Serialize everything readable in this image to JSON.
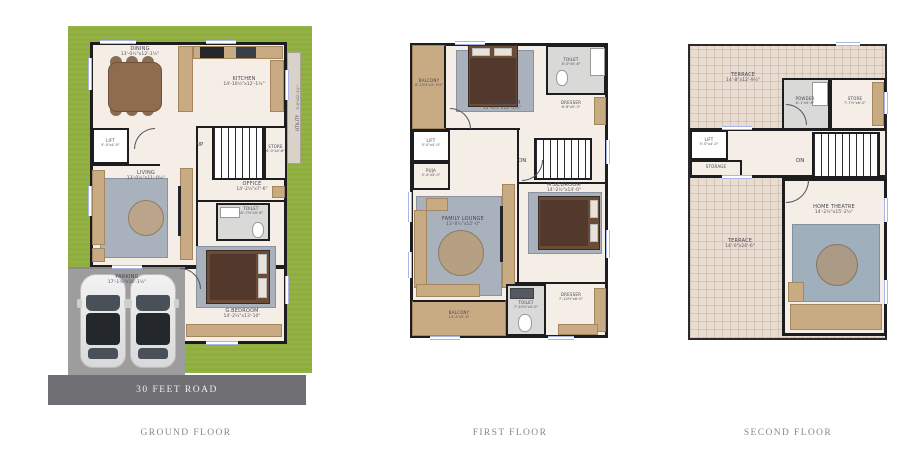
{
  "colors": {
    "lawn": "#8fae3e",
    "road": "#707074",
    "wall": "#1d1d20",
    "floor": "#f4eee6",
    "wood": "#c9ab83",
    "rug": "#a9b2bc",
    "terrace": "#e9ddd2",
    "parking": "#9d9d9d",
    "window": "#aab5ea",
    "label_text": "#474352",
    "caption_text": "#8b8589",
    "bed": "#6a4c38"
  },
  "floors": {
    "ground": {
      "caption": "GROUND FLOOR",
      "road": "30 FEET ROAD",
      "stairs": "UP",
      "rooms": {
        "dining": {
          "name": "DINING",
          "dims": "13'-0½\"x12'-1½\""
        },
        "kitchen": {
          "name": "KITCHEN",
          "dims": "14'-10½\"x12'-1½\""
        },
        "utility": {
          "name": "UTILITY",
          "dims": "3'-0\"x12'-1½\""
        },
        "lift": {
          "name": "LIFT",
          "dims": "5'-0\"x4'-0\""
        },
        "store": {
          "name": "STORE",
          "dims": "6'-0\"x4'-6\""
        },
        "living": {
          "name": "LIVING",
          "dims": "13'-0½\"x11'-0½\""
        },
        "office": {
          "name": "OFFICE",
          "dims": "14'-2½\"x7'-6\""
        },
        "toilet": {
          "name": "TOILET",
          "dims": "10'-7½\"x5'-6\""
        },
        "gbedroom": {
          "name": "G.BEDROOM",
          "dims": "14'-2½\"x13'-10\""
        },
        "parking": {
          "name": "PARKING",
          "dims": "17'-1½\"x16'-1½\""
        }
      }
    },
    "first": {
      "caption": "FIRST FLOOR",
      "stairs": "DN",
      "rooms": {
        "balcony_top": {
          "name": "BALCONY",
          "dims": "6'-10½\"x2'-9½\""
        },
        "ch_bedroom": {
          "name": "CH.BEDROOM",
          "dims": "13'-0½\"x12'-1½\""
        },
        "toilet_top": {
          "name": "TOILET",
          "dims": "8'-0\"x5'-6\""
        },
        "dresser_top": {
          "name": "DRESSER",
          "dims": "6'-6\"x5'-3\""
        },
        "lift": {
          "name": "LIFT",
          "dims": "5'-0\"x4'-0\""
        },
        "puja": {
          "name": "PUJA",
          "dims": "5'-4\"x4'-0\""
        },
        "m_bedroom": {
          "name": "M.BEDROOM",
          "dims": "14'-2½\"x14'-0\""
        },
        "family_lounge": {
          "name": "FAMILY LOUNGE",
          "dims": "13'-0½\"x12'-0\""
        },
        "toilet_bottom": {
          "name": "TOILET",
          "dims": "7'-10½\"x5'-0\""
        },
        "dresser_bottom": {
          "name": "DRESSER",
          "dims": "7'-10½\"x6'-0\""
        },
        "balcony_bottom": {
          "name": "BALCONY",
          "dims": "14'-4\"x5'-0\""
        }
      }
    },
    "second": {
      "caption": "SECOND FLOOR",
      "stairs": "DN",
      "rooms": {
        "terrace_top": {
          "name": "TERRACE",
          "dims": "14'-8\"x12'-9½\""
        },
        "powder": {
          "name": "POWDER",
          "dims": "6'-1\"x5'-6\""
        },
        "store": {
          "name": "STORE",
          "dims": "7'-7½\"x6'-0\""
        },
        "lift": {
          "name": "LIFT",
          "dims": "5'-0\"x4'-0\""
        },
        "storage": {
          "name": "STORAGE"
        },
        "home_theatre": {
          "name": "HOME THEATRE",
          "dims": "14'-2½\"x15'-2½\""
        },
        "terrace_bottom": {
          "name": "TERRACE",
          "dims": "14'-0\"x24'-6\""
        }
      }
    }
  }
}
